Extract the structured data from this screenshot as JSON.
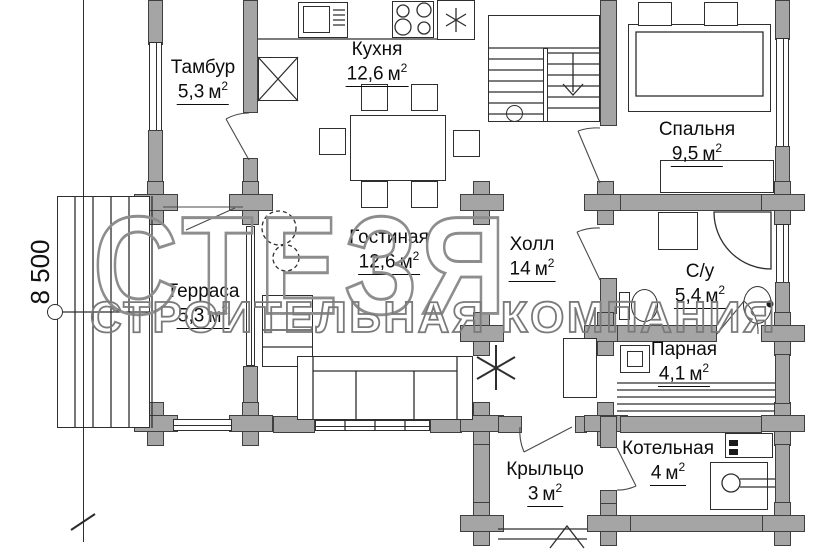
{
  "plan": {
    "watermark": {
      "line1": "СТЕЗЯ",
      "line2": "СТРОИТЕЛЬНАЯ КОМПАНИЯ"
    },
    "dimension": {
      "left": "8 500"
    },
    "area_unit": "м",
    "area_sup": "2",
    "rooms": [
      {
        "id": "tambur",
        "name": "Тамбур",
        "area": "5,3"
      },
      {
        "id": "kitchen",
        "name": "Кухня",
        "area": "12,6"
      },
      {
        "id": "bedroom",
        "name": "Спальня",
        "area": "9,5"
      },
      {
        "id": "living",
        "name": "Гостиная",
        "area": "12,6"
      },
      {
        "id": "hall",
        "name": "Холл",
        "area": "14"
      },
      {
        "id": "terrace",
        "name": "Терраса",
        "area": "5,3"
      },
      {
        "id": "bathroom",
        "name": "С/у",
        "area": "5,4"
      },
      {
        "id": "sauna",
        "name": "Парная",
        "area": "4,1"
      },
      {
        "id": "boiler",
        "name": "Котельная",
        "area": "4"
      },
      {
        "id": "porch",
        "name": "Крыльцо",
        "area": "3"
      }
    ]
  }
}
